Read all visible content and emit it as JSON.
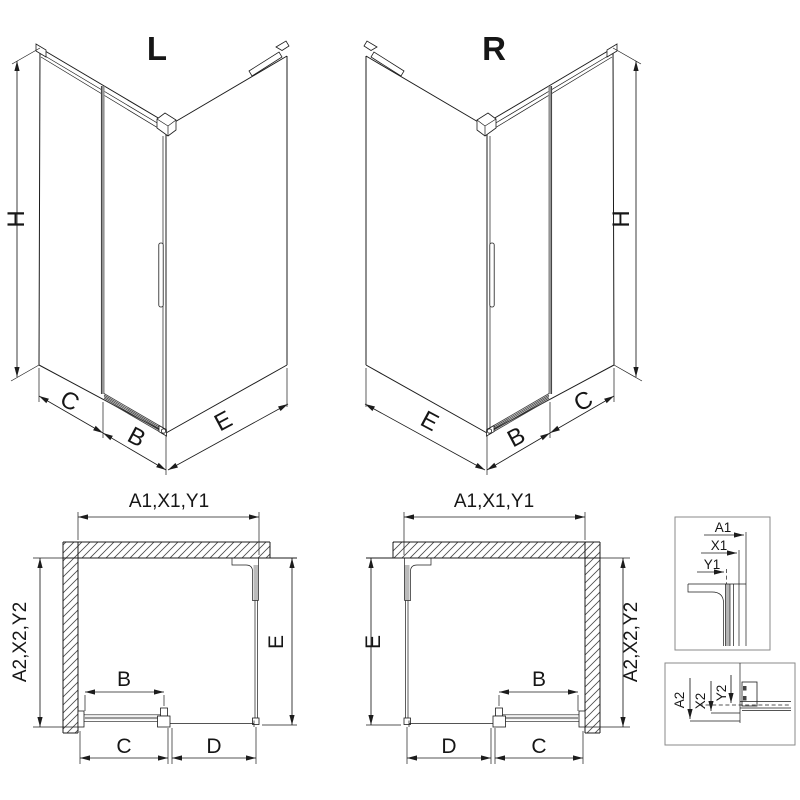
{
  "colors": {
    "line": "#1c1c1c",
    "glass_gray": "#949494",
    "hatch": "#4a4a4a",
    "detail_border": "#8a8a8a",
    "background": "#ffffff"
  },
  "iso_left": {
    "title": "L",
    "height_label": "H",
    "fixed_label": "C",
    "door_label": "B",
    "return_label": "E"
  },
  "iso_right": {
    "title": "R",
    "height_label": "H",
    "fixed_label": "C",
    "door_label": "B",
    "return_label": "E"
  },
  "plan_left": {
    "width_label": "A1,X1,Y1",
    "depth_label": "A2,X2,Y2",
    "return_label": "E",
    "door_label": "B",
    "fixed_label": "C",
    "panel_label": "D"
  },
  "plan_right": {
    "width_label": "A1,X1,Y1",
    "depth_label": "A2,X2,Y2",
    "return_label": "E",
    "door_label": "B",
    "fixed_label": "C",
    "panel_label": "D"
  },
  "detail_width": {
    "a": "A1",
    "x": "X1",
    "y": "Y1"
  },
  "detail_depth": {
    "a": "A2",
    "x": "X2",
    "y": "Y2"
  }
}
